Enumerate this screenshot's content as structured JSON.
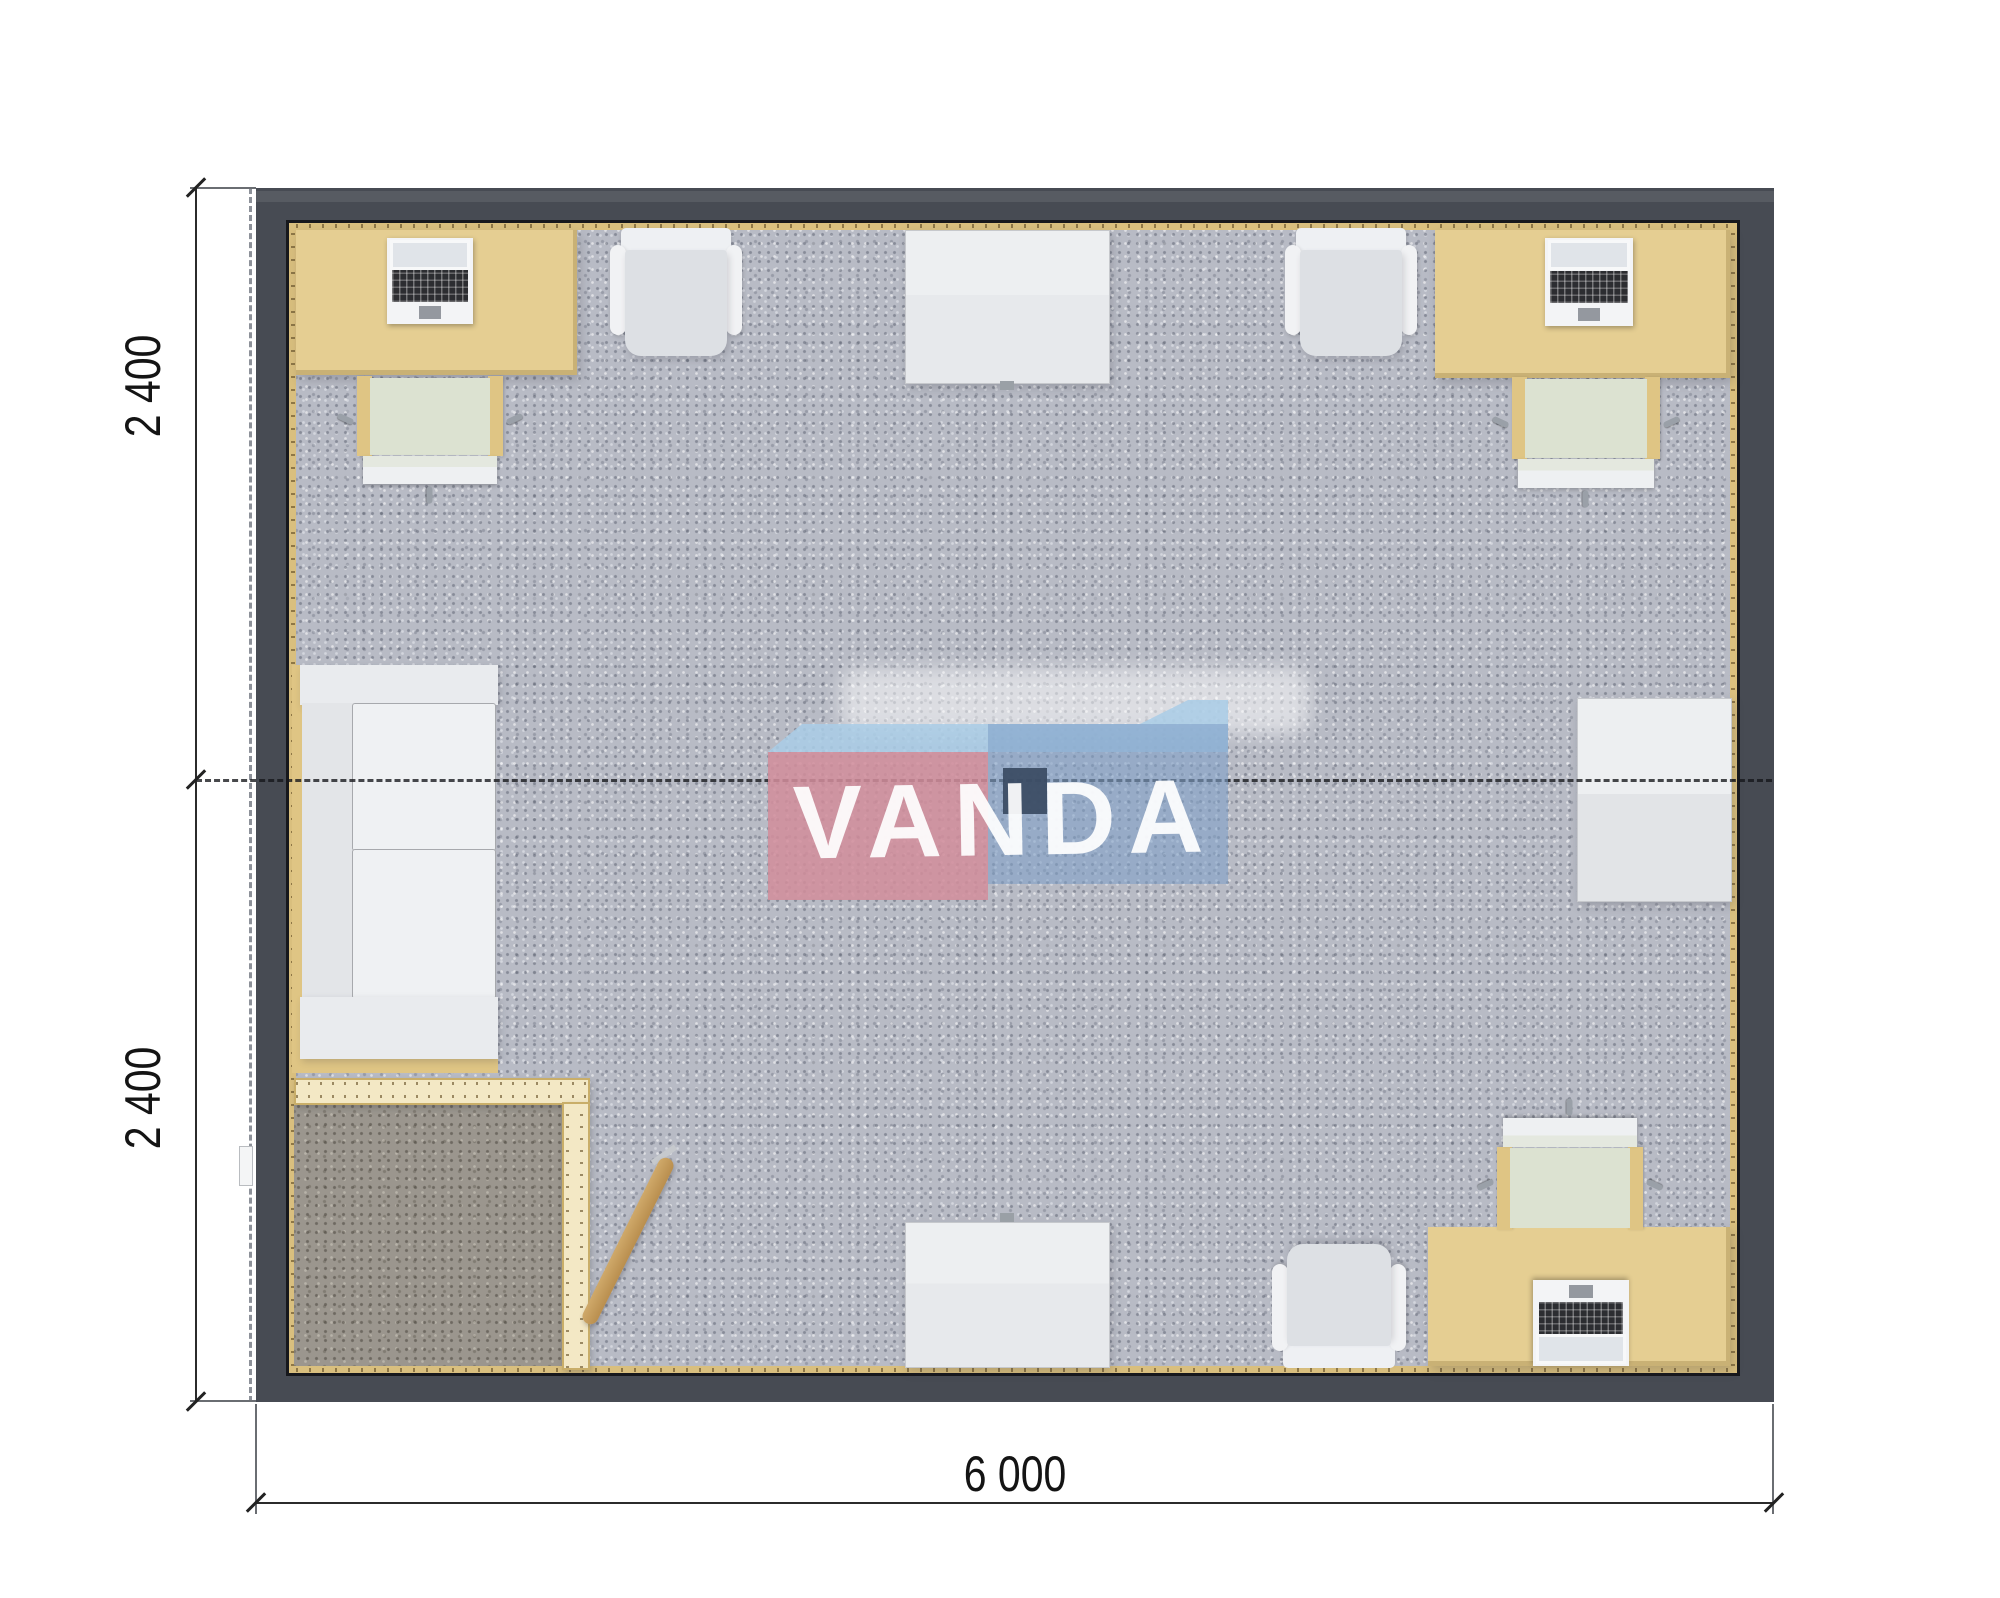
{
  "plan": {
    "dimensions": {
      "side_top": "2 400",
      "side_bottom": "2 400",
      "bottom": "6 000"
    },
    "watermark": {
      "text": "VANDA"
    },
    "colors": {
      "wall": "#474b53",
      "wall-edge": "#5e626b",
      "frame-line": "#17181c",
      "lining": "#d9bf7e",
      "desk": "#e5ce92",
      "desk-edge": "#c8a75f",
      "partition": "#f3e8c5",
      "partition-edge": "#c9ae69",
      "carpet": "#b8bbc5",
      "carpet-dark": "#9b968e",
      "sofa": "#e9ebee",
      "chair-seat": "#dce2d1",
      "chair-wood": "#dfc584",
      "white-furniture": "#e7e9ec",
      "logo-pink": "#d28d9b",
      "logo-top": "#a9cde6",
      "logo-blue": "#7fa0c8",
      "logo-navy": "#3a4b63",
      "dim-text": "#141414"
    },
    "inventory": [
      "desk-with-laptop-top-left",
      "office-chair-top-left",
      "armchair-top-left",
      "table-top-center",
      "armchair-top-right",
      "desk-with-laptop-top-right",
      "office-chair-top-right",
      "table-right",
      "sofa-left",
      "entry-room-partition",
      "leaning-plank",
      "table-bottom-center",
      "armchair-bottom",
      "desk-with-laptop-bottom-right",
      "office-chair-bottom-right",
      "ceiling-lamp"
    ]
  }
}
